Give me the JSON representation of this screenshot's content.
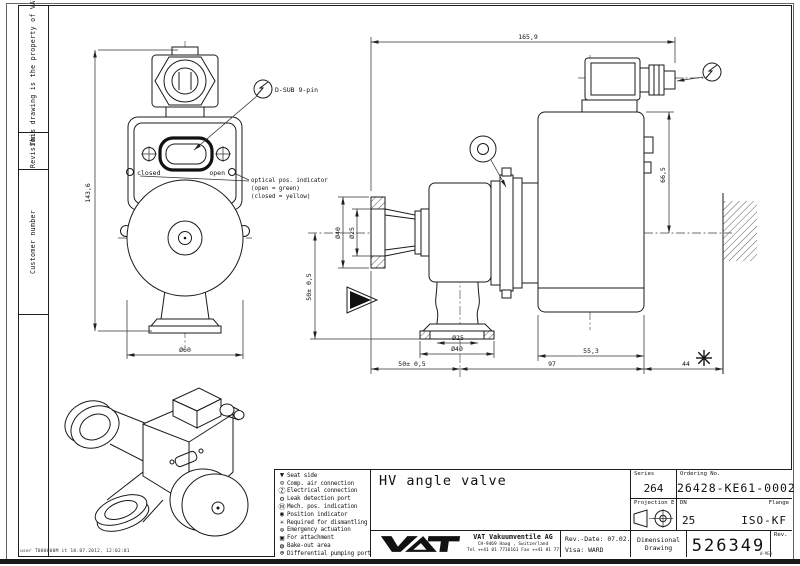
{
  "sheet": {
    "footer_note": "user T000000M it 10.07.2012, 12:02:01",
    "corner_mark": "W-MEA"
  },
  "sidebar": {
    "property_note": "This drawing is the property of VAT.",
    "revision": "Revision",
    "customer_number": "Customer number"
  },
  "front_view": {
    "dim_height": "143,6",
    "dim_actuator_diameter": "Ø60",
    "dsub_label": "D-SUB 9-pin",
    "closed_label": "closed",
    "open_label": "open",
    "indicator_note": [
      "optical pos. indicator",
      "(open = green)",
      "(closed = yellow)"
    ]
  },
  "side_view": {
    "dim_overall": "165,9",
    "dim_height": "66,5",
    "dim_port_od": "Ø40",
    "dim_port_id": "Ø25",
    "dim_center_to_flange": "50± 0,5",
    "dim_bottom_id": "Ø25",
    "dim_bottom_od": "Ø40",
    "dim_actuator_width": "55,3",
    "dim_chain_left": "50± 0,5",
    "dim_chain_mid": "97",
    "dim_chain_right": "44"
  },
  "legend": {
    "items": [
      {
        "glyph": "▼",
        "label": "Seat side"
      },
      {
        "glyph": "⊙",
        "label": "Comp. air connection"
      },
      {
        "glyph": "Ⓩ",
        "label": "Electrical connection"
      },
      {
        "glyph": "⚙",
        "label": "Leak detection port"
      },
      {
        "glyph": "Ⓜ",
        "label": "Mech. pos. indication"
      },
      {
        "glyph": "◉",
        "label": "Position indicator"
      },
      {
        "glyph": "✳",
        "label": "Required for dismantling"
      },
      {
        "glyph": "⊜",
        "label": "Emergency actuation"
      },
      {
        "glyph": "▣",
        "label": "For attachment"
      },
      {
        "glyph": "◍",
        "label": "Bake-out area"
      },
      {
        "glyph": "⊕",
        "label": "Differential pumping port"
      }
    ]
  },
  "title_block": {
    "title": "HV angle valve",
    "series_label": "Series",
    "series_value": "264",
    "ordering_no_label": "Ordering No.",
    "ordering_no_value": "26428-KE61-0002",
    "projection_label": "Projection E",
    "dn_label": "DN",
    "dn_value": "25",
    "flange_label": "Flange",
    "flange_value": "ISO-KF",
    "doc_type_line1": "Dimensional",
    "doc_type_line2": "Drawing",
    "drawing_number": "526349",
    "rev_label": "Rev.",
    "rev_date": "Rev.-Date: 07.02.12",
    "visa": "Visa: WARD",
    "company": {
      "name": "VAT Vakuumventile AG",
      "address": "CH-9469 Haag , Switzerland",
      "phone": "Tel ++41 81 7716161 Fax ++41 81 7714830"
    }
  }
}
